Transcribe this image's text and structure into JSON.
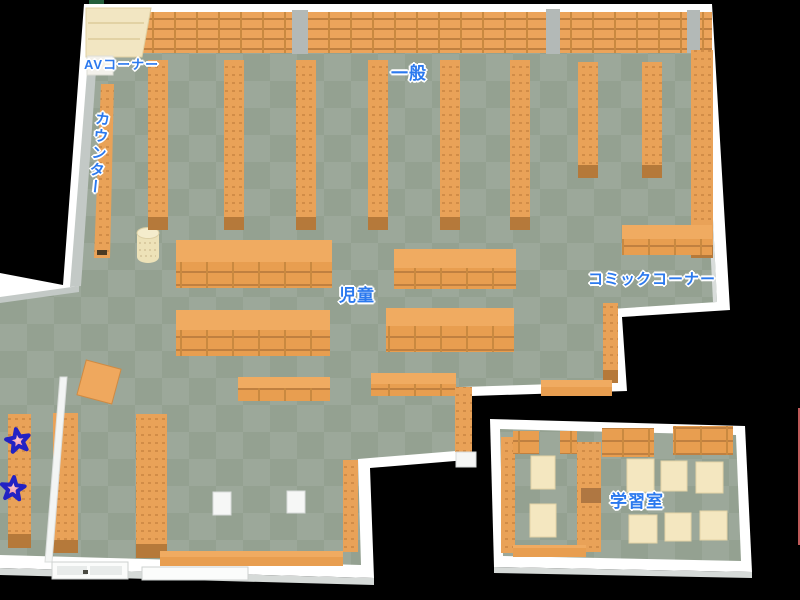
{
  "map": {
    "kind": "library-floor-map",
    "areas": [
      {
        "id": "av_corner",
        "label": "AVコーナー"
      },
      {
        "id": "counter",
        "label": "カウンター"
      },
      {
        "id": "general",
        "label": "一般"
      },
      {
        "id": "children",
        "label": "児童"
      },
      {
        "id": "comic_corner",
        "label": "コミックコーナー"
      },
      {
        "id": "study_room",
        "label": "学習室"
      }
    ],
    "markers": {
      "shape": "star",
      "count": 2,
      "fill": "#F48F9C",
      "outline": "#2222C4"
    },
    "colors": {
      "background": "#000000",
      "floor_dark": "#94A191",
      "floor_light": "#9CA89A",
      "wall": "#FFFFFF",
      "wall_shade": "#C3C9C6",
      "shelf_orange": "#E9A258",
      "shelf_top": "#F0AB61",
      "shelf_line": "#C08040",
      "shelf_cap": "#B5793A",
      "table_cream": "#F4E7C0",
      "label_blue": "#2B79EE"
    }
  }
}
